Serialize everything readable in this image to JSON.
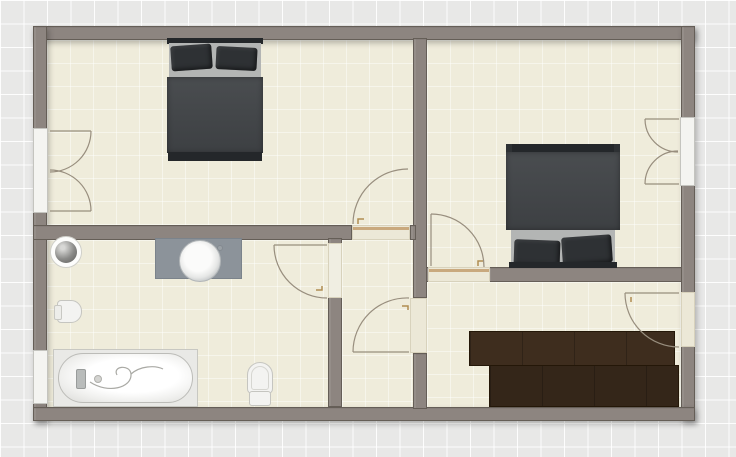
{
  "floor_plan": {
    "view": "top-down 2D apartment floor plan, no text labels visible",
    "palette": {
      "background": "#e8e8e7",
      "grid_line": "#ffffff",
      "wall": "#8d8580",
      "wall_edge": "#655e57",
      "floor": "#efecdb",
      "interior_door_opening": "#ece8d7",
      "door_threshold_tan": "#c9a97e",
      "window_white": "#f4f4f1",
      "swing_arc": "#988e7e",
      "bed_duvet": "#46494c",
      "bed_pillow": "#2e3134",
      "bed_sheet": "#b3b5b4",
      "wardrobe_brown": "#3e2d1e",
      "vanity_gray": "#8c939a",
      "fixture_white": "#f3f3f1"
    },
    "rooms": [
      {
        "name": "bedroom-left",
        "position": "top-left",
        "furniture": [
          "double-bed"
        ],
        "openings": [
          "double-french-door-left-wall",
          "interior-door-to-hall"
        ]
      },
      {
        "name": "bedroom-right",
        "position": "top-right",
        "furniture": [
          "double-bed"
        ],
        "openings": [
          "double-french-door-right-wall",
          "interior-door-to-dressing-room"
        ]
      },
      {
        "name": "bathroom",
        "position": "bottom-left",
        "fixtures": [
          "round-corner-basin",
          "vanity-with-round-sink",
          "bidet",
          "bathtub-with-shower-hose",
          "toilet"
        ],
        "openings": [
          "window-left-wall",
          "interior-door-to-hall"
        ]
      },
      {
        "name": "hall",
        "position": "bottom-center",
        "furniture": [],
        "openings": [
          "door-to-bedroom-left",
          "door-to-bathroom",
          "door-to-dressing-room"
        ]
      },
      {
        "name": "dressing-room",
        "position": "bottom-right",
        "furniture": [
          "l-shaped-wardrobe"
        ],
        "openings": [
          "entry-door-right-wall",
          "door-to-hall",
          "door-to-bedroom-right"
        ]
      }
    ],
    "counts": {
      "interior_doors": 5,
      "french_doors": 2,
      "windows": 1,
      "beds": 2,
      "wardrobes": 1,
      "bath_fixtures": 5
    }
  }
}
